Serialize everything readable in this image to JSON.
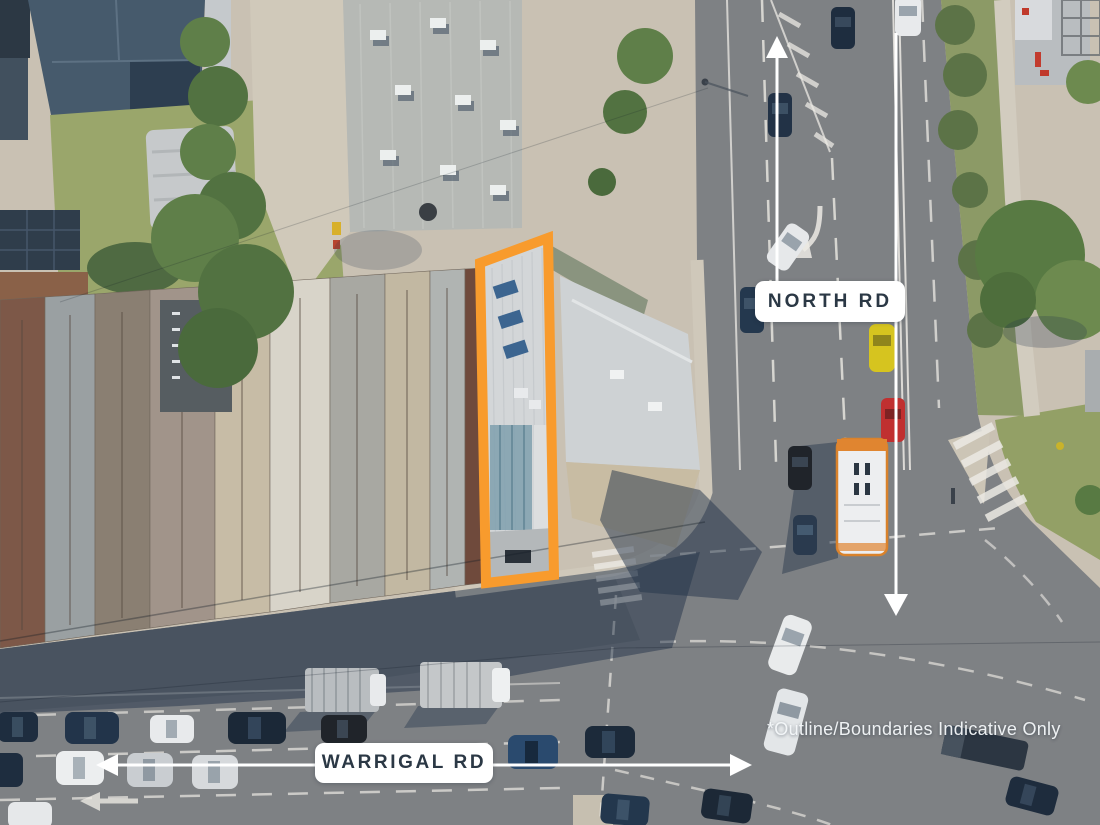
{
  "labels": {
    "north_rd": "NORTH RD",
    "warrigal_rd": "WARRIGAL RD"
  },
  "disclaimer": "*Outline/Boundaries Indicative Only",
  "annotations": {
    "north_rd_arrows": [
      "up",
      "down"
    ],
    "warrigal_rd_arrows": [
      "left",
      "right"
    ]
  },
  "colors": {
    "property_outline": "#F89B2D",
    "label_background": "#FFFFFF",
    "label_text": "#2B3845",
    "annotation_arrow": "#FFFFFF",
    "disclaimer_text": "#F4F7F9",
    "bus_accent": "#E08530"
  }
}
